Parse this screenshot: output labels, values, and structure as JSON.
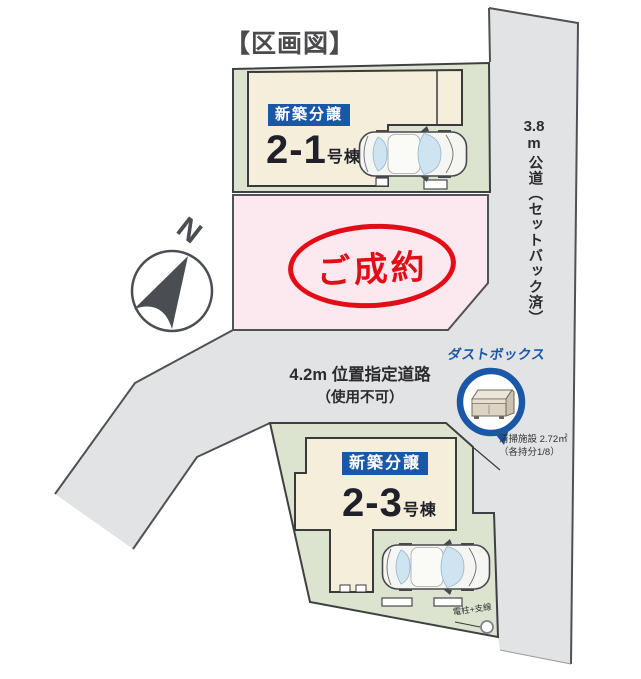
{
  "title": "【区画図】",
  "compass": {
    "north_label": "N"
  },
  "lots": {
    "lot21": {
      "badge": "新築分譲",
      "number": "2-1",
      "suffix": "号棟"
    },
    "lot23": {
      "badge": "新築分譲",
      "number": "2-3",
      "suffix": "号棟"
    },
    "sold": {
      "stamp": "ご成約"
    }
  },
  "roads": {
    "designated": {
      "line1": "4.2m 位置指定道路",
      "line2": "（使用不可）"
    },
    "public": {
      "value": "3.8",
      "unit": "m",
      "name": "公道（セットバック済）"
    }
  },
  "dust_box": {
    "label": "ダストボックス",
    "facility1": "清掃施設 2.72㎡",
    "facility2": "（各持分1/8）"
  },
  "utility": {
    "label": "電柱+支線"
  },
  "colors": {
    "accent_blue": "#1b57a7",
    "sold_red": "#e30d17",
    "lot_green": "#dce4cf",
    "building_cream": "#f4eedb",
    "lot_pink": "#fce9f0",
    "road_gray": "#e2e3e5",
    "outline_dark": "#4f5155"
  }
}
